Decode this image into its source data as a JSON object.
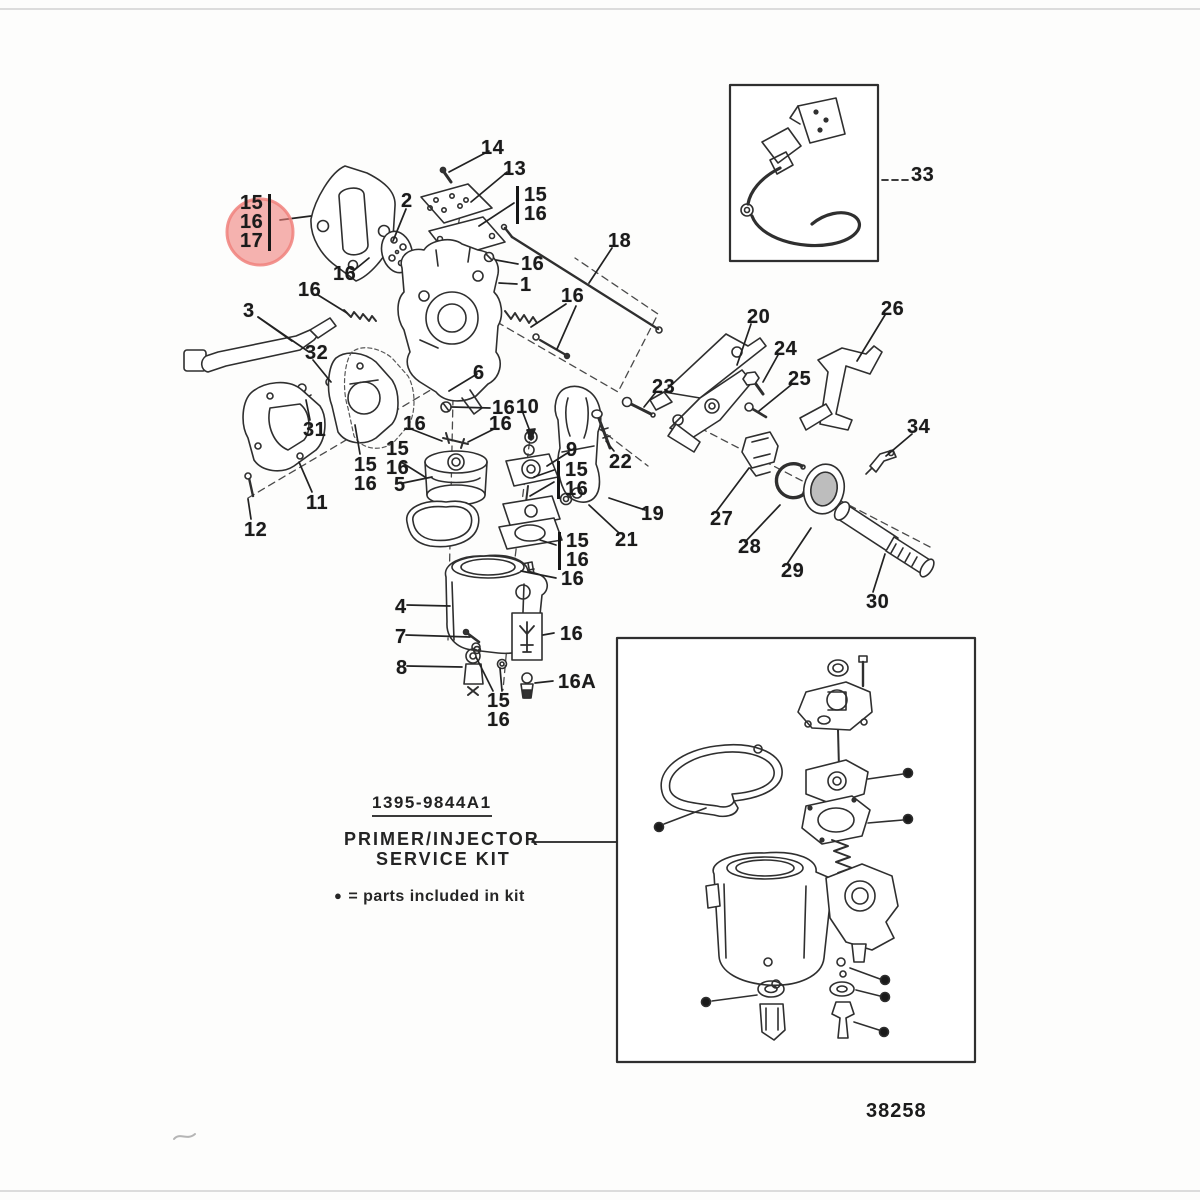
{
  "figure": {
    "drawing_number": "38258",
    "kit_part_number": "1395-9844A1",
    "kit_name_line1": "PRIMER/INJECTOR",
    "kit_name_line2": "SERVICE KIT",
    "legend_bullet": "●",
    "legend_text": "= parts included in kit"
  },
  "highlight": {
    "color": "#f0817c",
    "opacity": 0.6,
    "highlighted_labels": [
      "16",
      "17"
    ]
  },
  "callouts": [
    {
      "label": "14",
      "x": 481,
      "y": 139
    },
    {
      "label": "13",
      "x": 503,
      "y": 160
    },
    {
      "label": "15\n16",
      "x": 516,
      "y": 186,
      "bar": "left"
    },
    {
      "label": "2",
      "x": 401,
      "y": 192
    },
    {
      "label": "15\n16\n17",
      "x": 240,
      "y": 194,
      "bar": "right"
    },
    {
      "label": "16",
      "x": 333,
      "y": 265
    },
    {
      "label": "16",
      "x": 298,
      "y": 281
    },
    {
      "label": "3",
      "x": 243,
      "y": 302
    },
    {
      "label": "16",
      "x": 521,
      "y": 255
    },
    {
      "label": "1",
      "x": 520,
      "y": 276
    },
    {
      "label": "16",
      "x": 561,
      "y": 287
    },
    {
      "label": "18",
      "x": 608,
      "y": 232
    },
    {
      "label": "32",
      "x": 305,
      "y": 344
    },
    {
      "label": "31",
      "x": 303,
      "y": 421
    },
    {
      "label": "15\n16",
      "x": 354,
      "y": 456
    },
    {
      "label": "15\n16",
      "x": 386,
      "y": 440
    },
    {
      "label": "5",
      "x": 394,
      "y": 476
    },
    {
      "label": "11",
      "x": 306,
      "y": 494
    },
    {
      "label": "12",
      "x": 244,
      "y": 521
    },
    {
      "label": "16",
      "x": 492,
      "y": 399
    },
    {
      "label": "10",
      "x": 516,
      "y": 398
    },
    {
      "label": "6",
      "x": 473,
      "y": 364
    },
    {
      "label": "16",
      "x": 403,
      "y": 415
    },
    {
      "label": "16",
      "x": 489,
      "y": 415
    },
    {
      "label": "9",
      "x": 566,
      "y": 441
    },
    {
      "label": "15\n16",
      "x": 557,
      "y": 461,
      "bar": "left"
    },
    {
      "label": "22",
      "x": 609,
      "y": 453
    },
    {
      "label": "23",
      "x": 652,
      "y": 378
    },
    {
      "label": "19",
      "x": 641,
      "y": 505
    },
    {
      "label": "21",
      "x": 615,
      "y": 531
    },
    {
      "label": "20",
      "x": 747,
      "y": 308
    },
    {
      "label": "24",
      "x": 774,
      "y": 340
    },
    {
      "label": "25",
      "x": 788,
      "y": 370
    },
    {
      "label": "26",
      "x": 881,
      "y": 300
    },
    {
      "label": "34",
      "x": 907,
      "y": 418
    },
    {
      "label": "27",
      "x": 710,
      "y": 510
    },
    {
      "label": "28",
      "x": 738,
      "y": 538
    },
    {
      "label": "29",
      "x": 781,
      "y": 562
    },
    {
      "label": "30",
      "x": 866,
      "y": 593
    },
    {
      "label": "33",
      "x": 911,
      "y": 166
    },
    {
      "label": "4",
      "x": 395,
      "y": 598
    },
    {
      "label": "7",
      "x": 395,
      "y": 628
    },
    {
      "label": "8",
      "x": 396,
      "y": 659
    },
    {
      "label": "15\n16",
      "x": 558,
      "y": 532,
      "bar": "left"
    },
    {
      "label": "16",
      "x": 561,
      "y": 570
    },
    {
      "label": "16",
      "x": 560,
      "y": 625
    },
    {
      "label": "16A",
      "x": 558,
      "y": 673
    },
    {
      "label": "15\n16",
      "x": 487,
      "y": 692
    }
  ]
}
